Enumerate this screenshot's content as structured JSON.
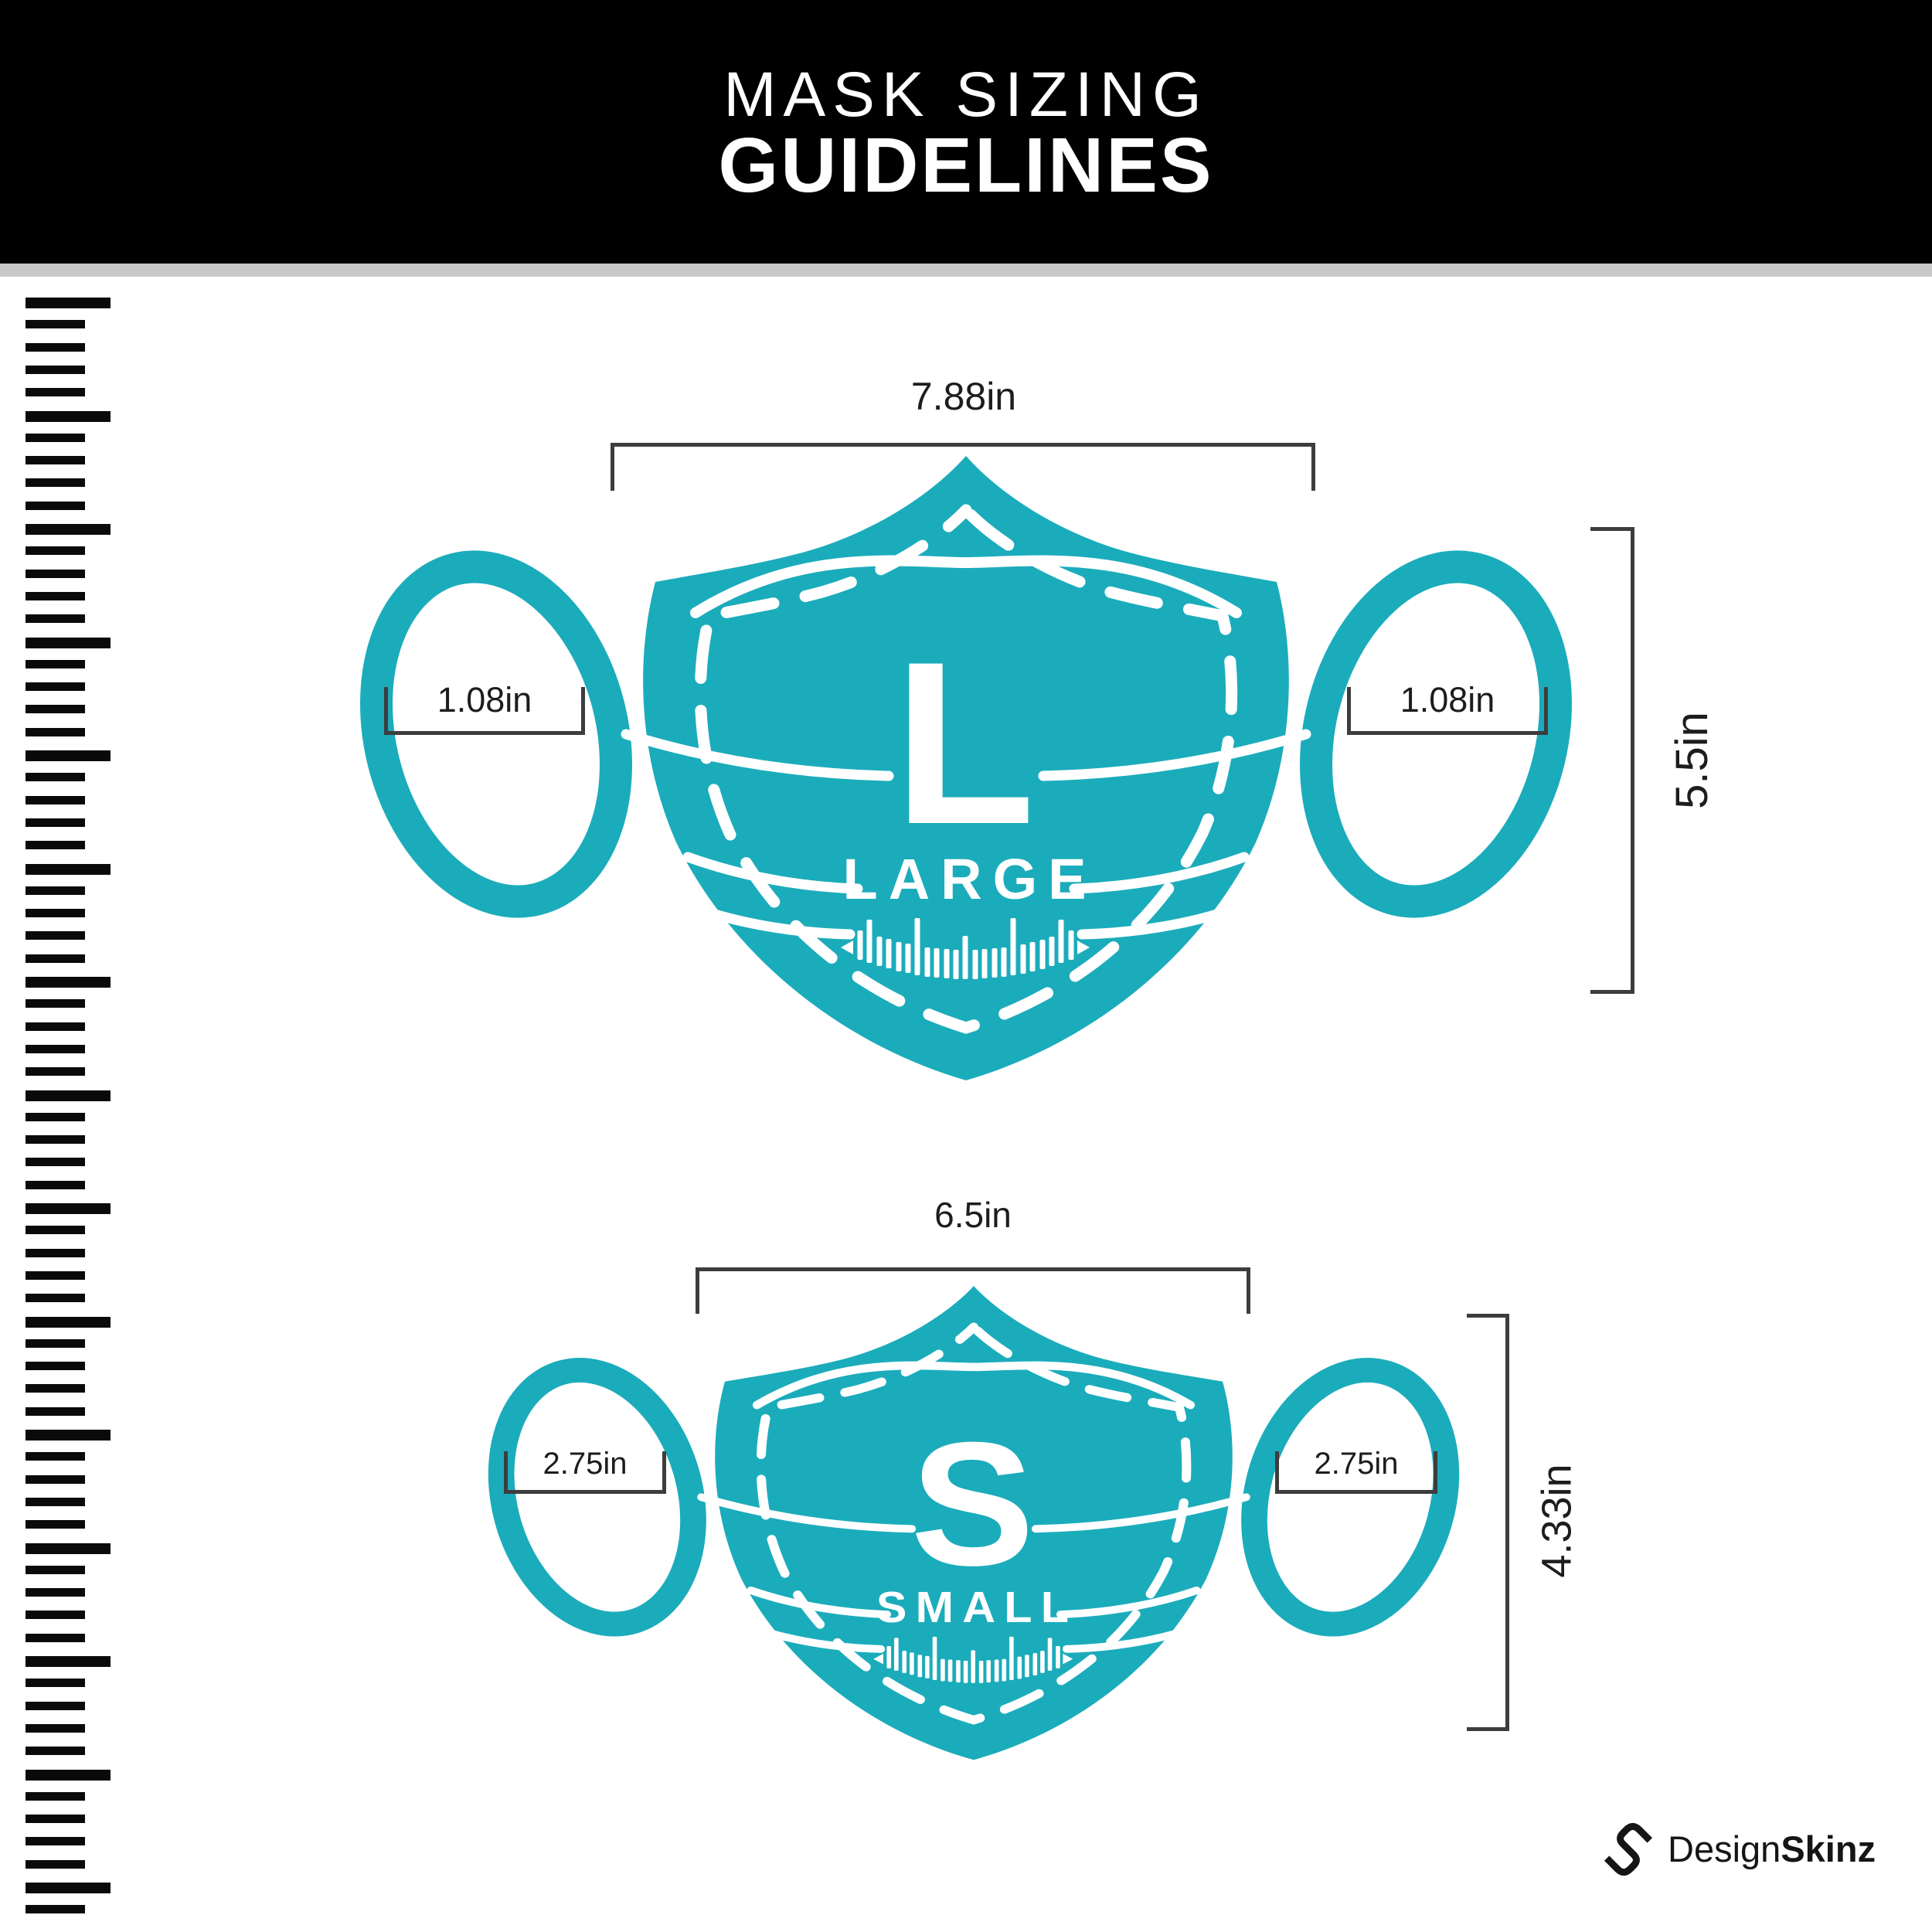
{
  "header": {
    "title_line1": "MASK SIZING",
    "title_line2": "GUIDELINES"
  },
  "masks": {
    "large": {
      "letter": "L",
      "size_label": "LARGE",
      "width_label": "7.88in",
      "ear_left_label": "1.08in",
      "ear_right_label": "1.08in",
      "height_label": "5.5in"
    },
    "small": {
      "letter": "S",
      "size_label": "SMALL",
      "width_label": "6.5in",
      "ear_left_label": "2.75in",
      "ear_right_label": "2.75in",
      "height_label": "4.33in"
    }
  },
  "brand": {
    "name_regular": "Design",
    "name_bold": "Skinz"
  },
  "colors": {
    "mask_teal": "#1BACBB",
    "header_bg": "#000000",
    "divider": "#C9C9C9",
    "dimension": "#3D3D3D",
    "ruler": "#0A0A0A"
  }
}
